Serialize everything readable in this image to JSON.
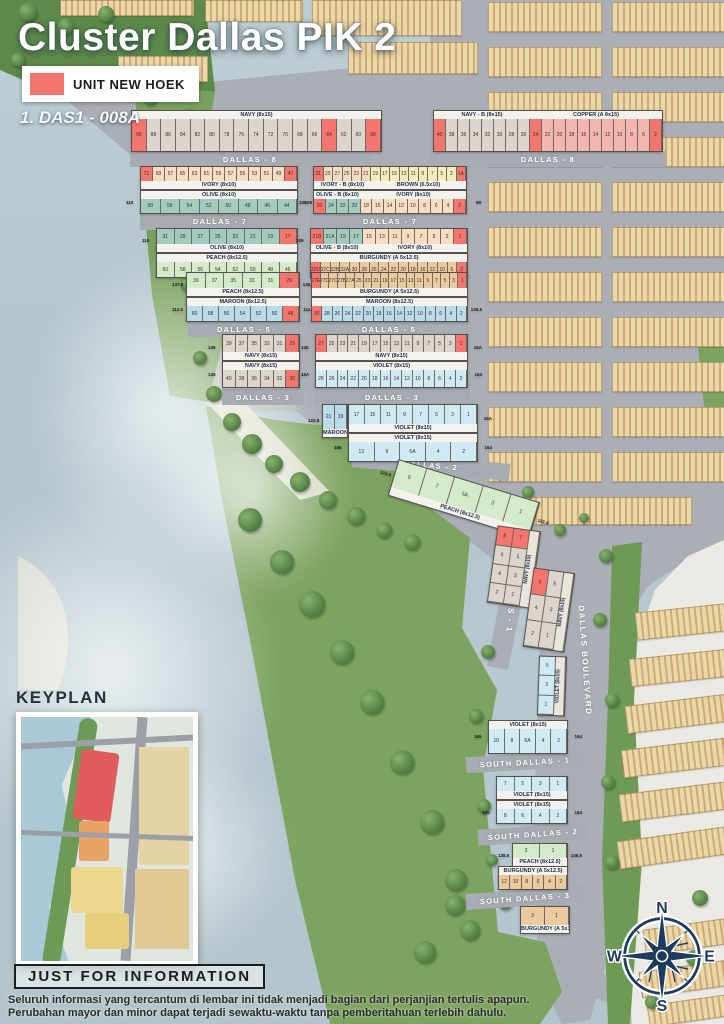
{
  "title": "Cluster Dallas PIK 2",
  "legend": {
    "label": "UNIT NEW HOEK",
    "color": "#f4756d"
  },
  "annotation": "1. DAS1 - 008A",
  "keyplan": {
    "title": "KEYPLAN"
  },
  "footer": {
    "heading": "JUST FOR INFORMATION",
    "line1": "Seluruh informasi yang tercantum di lembar ini tidak menjadi bagian dari perjanjian tertulis apapun.",
    "line2": "Perubahan mayor dan minor dapat terjadi sewaktu-waktu tanpa pemberitahuan terlebih dahulu."
  },
  "compass": {
    "n": "N",
    "e": "E",
    "s": "S",
    "w": "W"
  },
  "palette": {
    "hoek": "#f4756d",
    "navy": "#dbd5cd",
    "copper": "#f2b6ae",
    "ivory": "#f7dcc2",
    "brown": "#f3ecba",
    "olive": "#a2cabe",
    "peach": "#d4ebcb",
    "burgundy": "#eccaa0",
    "maroon": "#badbe9",
    "violet": "#cfeaf3",
    "street": "#a6acb2",
    "water": "#b8c8d0",
    "green": "#7ca35f"
  },
  "streets": {
    "d8l": "DALLAS - 8",
    "d8r": "DALLAS - 8",
    "d7l": "DALLAS - 7",
    "d7r": "DALLAS - 7",
    "d6l": "DALLAS - 6",
    "d6r": "DALLAS - 6",
    "d5l": "DALLAS - 5",
    "d5r": "DALLAS - 5",
    "d3l": "DALLAS - 3",
    "d3r": "DALLAS - 3",
    "d2": "DALLAS - 2",
    "d1": "DALLAS - 1",
    "sd1": "SOUTH DALLAS - 1",
    "sd2": "SOUTH DALLAS - 2",
    "sd3": "SOUTH DALLAS - 3",
    "blvd": "DALLAS BOULEVARD"
  },
  "rows": {
    "r_b8L": {
      "spans": [
        {
          "label": "NAVY (8x15)",
          "color": "navy",
          "count": 17
        }
      ],
      "cells": [
        "90",
        "88",
        "86",
        "84",
        "82",
        "80",
        "78",
        "76",
        "74",
        "72",
        "70",
        "68",
        "66",
        "64",
        "62",
        "60",
        "58"
      ],
      "hoek": [
        0,
        13,
        16
      ],
      "labelPos": "top"
    },
    "r_b8R": {
      "spans": [
        {
          "label": "NAVY - B (8x15)",
          "color": "navy",
          "count": 8
        },
        {
          "label": "COPPER (A 8x15)",
          "color": "copper",
          "count": 11
        }
      ],
      "cells": [
        "40",
        "38",
        "36",
        "34",
        "32",
        "30",
        "28",
        "26",
        "24",
        "22",
        "20",
        "18",
        "16",
        "14",
        "12",
        "10",
        "8",
        "6",
        "2"
      ],
      "hoek": [
        0,
        8,
        18
      ],
      "labelPos": "top"
    },
    "r_ivoryL": {
      "spans": [
        {
          "label": "IVORY (8x10)",
          "color": "ivory",
          "count": 13
        }
      ],
      "cells": [
        "71",
        "69",
        "67",
        "65",
        "63",
        "61",
        "59",
        "57",
        "55",
        "53",
        "51",
        "49",
        "47"
      ],
      "hoek": [
        0,
        12
      ],
      "labelPos": "bottom"
    },
    "r_oliveL7": {
      "spans": [
        {
          "label": "OLIVE (8x10)",
          "color": "olive",
          "count": 8
        }
      ],
      "cells": [
        "58",
        "56",
        "54",
        "52",
        "50",
        "48",
        "46",
        "44"
      ],
      "hoek": [],
      "labelPos": "top",
      "endL": "110",
      "endR": "109"
    },
    "r_ivbR": {
      "spans": [
        {
          "label": "IVORY - B (8x10)",
          "color": "ivory",
          "count": 6
        },
        {
          "label": "BROWN (6.5x10)",
          "color": "brown",
          "count": 10
        }
      ],
      "cells": [
        "31",
        "29",
        "27",
        "25",
        "23",
        "21",
        "19",
        "17",
        "15",
        "13",
        "11",
        "9",
        "7",
        "5",
        "3",
        "1A"
      ],
      "hoek": [
        0,
        15
      ],
      "labelPos": "bottom"
    },
    "r_olbR": {
      "spans": [
        {
          "label": "OLIVE - B (8x10)",
          "color": "olive",
          "count": 4
        },
        {
          "label": "IVORY (8x10)",
          "color": "ivory",
          "count": 9
        }
      ],
      "cells": [
        "26",
        "24",
        "22",
        "20",
        "18",
        "16",
        "14",
        "12",
        "10",
        "8",
        "6",
        "4",
        "2"
      ],
      "hoek": [
        0,
        12
      ],
      "labelPos": "top",
      "endL": "109",
      "endR": "89"
    },
    "r_olive6": {
      "spans": [
        {
          "label": "OLIVE (8x10)",
          "color": "olive",
          "count": 8
        }
      ],
      "cells": [
        "31",
        "29",
        "27",
        "25",
        "23",
        "21",
        "19",
        "17"
      ],
      "hoek": [
        7
      ],
      "labelPos": "bottom",
      "endL": "110"
    },
    "r_peach6": {
      "spans": [
        {
          "label": "PEACH (8x12.5)",
          "color": "peach",
          "count": 8
        }
      ],
      "cells": [
        "60",
        "58",
        "56",
        "54",
        "52",
        "50",
        "48",
        "46"
      ],
      "hoek": [],
      "labelPos": "top"
    },
    "r_olb6": {
      "spans": [
        {
          "label": "OLIVE - B (8x10)",
          "color": "olive",
          "count": 4
        },
        {
          "label": "IVORY (8x10)",
          "color": "ivory",
          "count": 8
        }
      ],
      "cells": [
        "21B",
        "21A",
        "19",
        "17",
        "15",
        "13",
        "11",
        "9",
        "7",
        "5",
        "3",
        "1"
      ],
      "hoek": [
        0,
        11
      ],
      "labelPos": "bottom",
      "endL": "109"
    },
    "r_burg6": {
      "spans": [
        {
          "label": "BURGUNDY (A 5x12.5)",
          "color": "burgundy",
          "count": 16
        }
      ],
      "cells": [
        "32D",
        "32C",
        "32B",
        "32A",
        "30",
        "28",
        "26",
        "24",
        "22",
        "20",
        "18",
        "16",
        "12",
        "10",
        "6",
        "2"
      ],
      "hoek": [
        0,
        15
      ],
      "labelPos": "top"
    },
    "r_peach5": {
      "spans": [
        {
          "label": "PEACH (8x12.5)",
          "color": "peach",
          "count": 6
        }
      ],
      "cells": [
        "39",
        "37",
        "35",
        "33",
        "31",
        "29"
      ],
      "hoek": [
        5
      ],
      "labelPos": "bottom",
      "endL": "137.5",
      "endR": "136.5"
    },
    "r_maroon5L": {
      "spans": [
        {
          "label": "MAROON (8x12.5)",
          "color": "maroon",
          "count": 7
        }
      ],
      "cells": [
        "60",
        "58",
        "56",
        "54",
        "52",
        "50",
        "48"
      ],
      "hoek": [
        6
      ],
      "labelPos": "top",
      "endL": "112.5",
      "endR": "111.5"
    },
    "r_burg5": {
      "spans": [
        {
          "label": "BURGUNDY (A 5x12.5)",
          "color": "burgundy",
          "count": 18
        }
      ],
      "cells": [
        "27E",
        "27D",
        "27C",
        "27B",
        "27A",
        "25",
        "23",
        "21",
        "19",
        "17",
        "15",
        "13",
        "11",
        "9",
        "7",
        "5",
        "3",
        "1"
      ],
      "hoek": [
        0,
        17
      ],
      "labelPos": "bottom"
    },
    "r_maroon5R": {
      "spans": [
        {
          "label": "MAROON (8x12.5)",
          "color": "maroon",
          "count": 15
        }
      ],
      "cells": [
        "30",
        "28",
        "26",
        "24",
        "22",
        "20",
        "18",
        "16",
        "14",
        "12",
        "10",
        "8",
        "6",
        "4",
        "2"
      ],
      "hoek": [
        0
      ],
      "labelPos": "top",
      "endR": "136.5"
    },
    "r_navy3a": {
      "spans": [
        {
          "label": "NAVY (8x15)",
          "color": "navy",
          "count": 6
        }
      ],
      "cells": [
        "39",
        "37",
        "35",
        "33",
        "31",
        "29"
      ],
      "hoek": [
        5
      ],
      "labelPos": "bottom",
      "endL": "135"
    },
    "r_navy3b": {
      "spans": [
        {
          "label": "NAVY (8x15)",
          "color": "navy",
          "count": 6
        }
      ],
      "cells": [
        "40",
        "38",
        "36",
        "34",
        "32",
        "30"
      ],
      "hoek": [
        5
      ],
      "labelPos": "top",
      "endL": "135"
    },
    "r_navy3R": {
      "spans": [
        {
          "label": "NAVY (8x15)",
          "color": "navy",
          "count": 14
        }
      ],
      "cells": [
        "27",
        "25",
        "23",
        "21",
        "19",
        "17",
        "15",
        "13",
        "11",
        "9",
        "7",
        "5",
        "3",
        "1"
      ],
      "hoek": [
        0,
        13
      ],
      "labelPos": "bottom",
      "endL": "136",
      "endR": "16A"
    },
    "r_violet3R": {
      "spans": [
        {
          "label": "VIOLET (8x15)",
          "color": "violet",
          "count": 14
        }
      ],
      "cells": [
        "28",
        "26",
        "24",
        "22",
        "20",
        "18",
        "16",
        "14",
        "12",
        "10",
        "8",
        "6",
        "4",
        "2"
      ],
      "hoek": [],
      "labelPos": "top",
      "endL": "16A",
      "endR": "164"
    },
    "r_maroon2": {
      "spans": [
        {
          "label": "MAROON (8x12.5)",
          "color": "maroon",
          "count": 2
        }
      ],
      "cells": [
        "21",
        "19"
      ],
      "hoek": [],
      "labelPos": "bottom",
      "endL": "122.5"
    },
    "r_violet2a": {
      "spans": [
        {
          "label": "VIOLET (8x15)",
          "color": "violet",
          "count": 8
        }
      ],
      "cells": [
        "17",
        "15",
        "11",
        "9",
        "7",
        "5",
        "3",
        "1"
      ],
      "hoek": [],
      "labelPos": "bottom",
      "endR": "16A"
    },
    "r_violet2b": {
      "spans": [
        {
          "label": "VIOLET (8x15)",
          "color": "violet",
          "count": 5
        }
      ],
      "cells": [
        "13",
        "9",
        "6A",
        "4",
        "2"
      ],
      "hoek": [],
      "labelPos": "top",
      "endL": "165",
      "endR": "164"
    },
    "r_peachD": {
      "spans": [
        {
          "label": "PEACH (8x12.5)",
          "color": "peach",
          "count": 5
        }
      ],
      "cells": [
        "9",
        "7",
        "5A",
        "3",
        "1"
      ],
      "hoek": [],
      "labelPos": "bottom",
      "endL": "123.5",
      "endR": "121.5"
    },
    "r_navyV1": {
      "type": "vcol2",
      "vlabel": "NAVY (8x15)",
      "color": "navy",
      "cells": [
        [
          "8",
          "7"
        ],
        [
          "6",
          "5"
        ],
        [
          "4",
          "3"
        ],
        [
          "2",
          "1"
        ]
      ],
      "hoek": [
        "0,0",
        "0,1"
      ]
    },
    "r_navyV2": {
      "type": "vcol2",
      "vlabel": "NAVY (8x15)",
      "color": "navy",
      "cells": [
        [
          "6",
          "5"
        ],
        [
          "4",
          "3"
        ],
        [
          "2",
          "1"
        ]
      ],
      "hoek": [
        "0,0"
      ]
    },
    "r_violetV": {
      "type": "vcol1",
      "vlabel": "VIOLET (8x15)",
      "color": "violet",
      "cells": [
        "5",
        "3",
        "1"
      ],
      "hoek": []
    },
    "r_violetR1": {
      "spans": [
        {
          "label": "VIOLET (8x15)",
          "color": "violet",
          "count": 5
        }
      ],
      "cells": [
        "10",
        "8",
        "6A",
        "4",
        "2"
      ],
      "hoek": [],
      "labelPos": "top",
      "endL": "165",
      "endR": "164"
    },
    "r_violetS1a": {
      "spans": [
        {
          "label": "VIOLET (8x15)",
          "color": "violet",
          "count": 4
        }
      ],
      "cells": [
        "7",
        "5",
        "3",
        "1"
      ],
      "hoek": [],
      "labelPos": "bottom"
    },
    "r_violetS1b": {
      "spans": [
        {
          "label": "VIOLET (8x15)",
          "color": "violet",
          "count": 4
        }
      ],
      "cells": [
        "8",
        "6",
        "4",
        "2"
      ],
      "hoek": [],
      "labelPos": "top",
      "endL": "165",
      "endR": "164"
    },
    "r_peachS2": {
      "spans": [
        {
          "label": "PEACH (8x12.5)",
          "color": "peach",
          "count": 2
        }
      ],
      "cells": [
        "3",
        "1"
      ],
      "hoek": [],
      "labelPos": "bottom",
      "endL": "138.5",
      "endR": "136.5"
    },
    "r_burgS2": {
      "spans": [
        {
          "label": "BURGUNDY (A 5x12.5)",
          "color": "burgundy",
          "count": 6
        }
      ],
      "cells": [
        "12",
        "10",
        "8",
        "6",
        "4",
        "2"
      ],
      "hoek": [],
      "labelPos": "top"
    },
    "r_burgS3": {
      "spans": [
        {
          "label": "BURGUNDY (A 5x12.5)",
          "color": "burgundy",
          "count": 2
        }
      ],
      "cells": [
        "3",
        "1"
      ],
      "hoek": [],
      "labelPos": "bottom"
    }
  },
  "decor": {
    "strips": [
      [
        205,
        0,
        96,
        20,
        0
      ],
      [
        312,
        0,
        148,
        34,
        0
      ],
      [
        348,
        42,
        128,
        30,
        0
      ],
      [
        118,
        56,
        88,
        24,
        0
      ],
      [
        60,
        0,
        132,
        14,
        0
      ],
      [
        488,
        2,
        112,
        28,
        0
      ],
      [
        488,
        47,
        112,
        28,
        0
      ],
      [
        488,
        92,
        112,
        28,
        0
      ],
      [
        488,
        137,
        112,
        28,
        0
      ],
      [
        488,
        182,
        112,
        28,
        0
      ],
      [
        488,
        227,
        112,
        28,
        0
      ],
      [
        488,
        272,
        112,
        28,
        0
      ],
      [
        488,
        317,
        112,
        28,
        0
      ],
      [
        488,
        362,
        112,
        28,
        0
      ],
      [
        488,
        407,
        112,
        28,
        0
      ],
      [
        488,
        452,
        112,
        28,
        0
      ],
      [
        612,
        2,
        112,
        28,
        0
      ],
      [
        612,
        47,
        112,
        28,
        0
      ],
      [
        612,
        92,
        112,
        28,
        0
      ],
      [
        612,
        137,
        112,
        28,
        0
      ],
      [
        612,
        182,
        112,
        28,
        0
      ],
      [
        612,
        227,
        112,
        28,
        0
      ],
      [
        612,
        272,
        112,
        28,
        0
      ],
      [
        612,
        317,
        112,
        28,
        0
      ],
      [
        612,
        362,
        112,
        28,
        0
      ],
      [
        612,
        407,
        112,
        28,
        0
      ],
      [
        612,
        452,
        112,
        28,
        0
      ],
      [
        500,
        497,
        190,
        26,
        0
      ],
      [
        636,
        608,
        88,
        26,
        -6
      ],
      [
        630,
        654,
        94,
        26,
        -6
      ],
      [
        626,
        700,
        98,
        26,
        -7
      ],
      [
        622,
        744,
        102,
        26,
        -7
      ],
      [
        620,
        788,
        104,
        26,
        -7
      ],
      [
        618,
        834,
        106,
        26,
        -8
      ],
      [
        644,
        924,
        80,
        24,
        -8
      ],
      [
        640,
        966,
        84,
        24,
        -8
      ],
      [
        648,
        1000,
        76,
        20,
        -8
      ]
    ],
    "trees": [
      [
        150,
        98,
        7
      ],
      [
        188,
        116,
        8
      ],
      [
        166,
        158,
        7
      ],
      [
        154,
        198,
        6
      ],
      [
        172,
        240,
        7
      ],
      [
        188,
        284,
        8
      ],
      [
        214,
        318,
        7
      ],
      [
        200,
        358,
        7
      ],
      [
        214,
        394,
        8
      ],
      [
        232,
        422,
        9
      ],
      [
        252,
        444,
        10
      ],
      [
        274,
        464,
        9
      ],
      [
        300,
        482,
        10
      ],
      [
        328,
        500,
        9
      ],
      [
        356,
        516,
        9
      ],
      [
        384,
        530,
        8
      ],
      [
        412,
        542,
        8
      ],
      [
        250,
        520,
        12
      ],
      [
        282,
        562,
        12
      ],
      [
        312,
        604,
        13
      ],
      [
        342,
        652,
        12
      ],
      [
        372,
        702,
        12
      ],
      [
        402,
        762,
        12
      ],
      [
        432,
        822,
        12
      ],
      [
        456,
        880,
        11
      ],
      [
        470,
        930,
        10
      ],
      [
        500,
        472,
        7
      ],
      [
        528,
        492,
        6
      ],
      [
        606,
        556,
        7
      ],
      [
        600,
        620,
        7
      ],
      [
        612,
        700,
        7
      ],
      [
        608,
        782,
        7
      ],
      [
        612,
        862,
        7
      ],
      [
        700,
        898,
        8
      ],
      [
        694,
        958,
        8
      ],
      [
        652,
        1002,
        7
      ],
      [
        28,
        12,
        9
      ],
      [
        66,
        26,
        8
      ],
      [
        106,
        14,
        8
      ],
      [
        18,
        60,
        7
      ],
      [
        488,
        652,
        7
      ],
      [
        476,
        716,
        7
      ],
      [
        484,
        806,
        7
      ],
      [
        492,
        860,
        6
      ],
      [
        560,
        530,
        6
      ],
      [
        584,
        518,
        5
      ],
      [
        455,
        905,
        10
      ],
      [
        425,
        952,
        11
      ],
      [
        505,
        903,
        7
      ]
    ]
  }
}
